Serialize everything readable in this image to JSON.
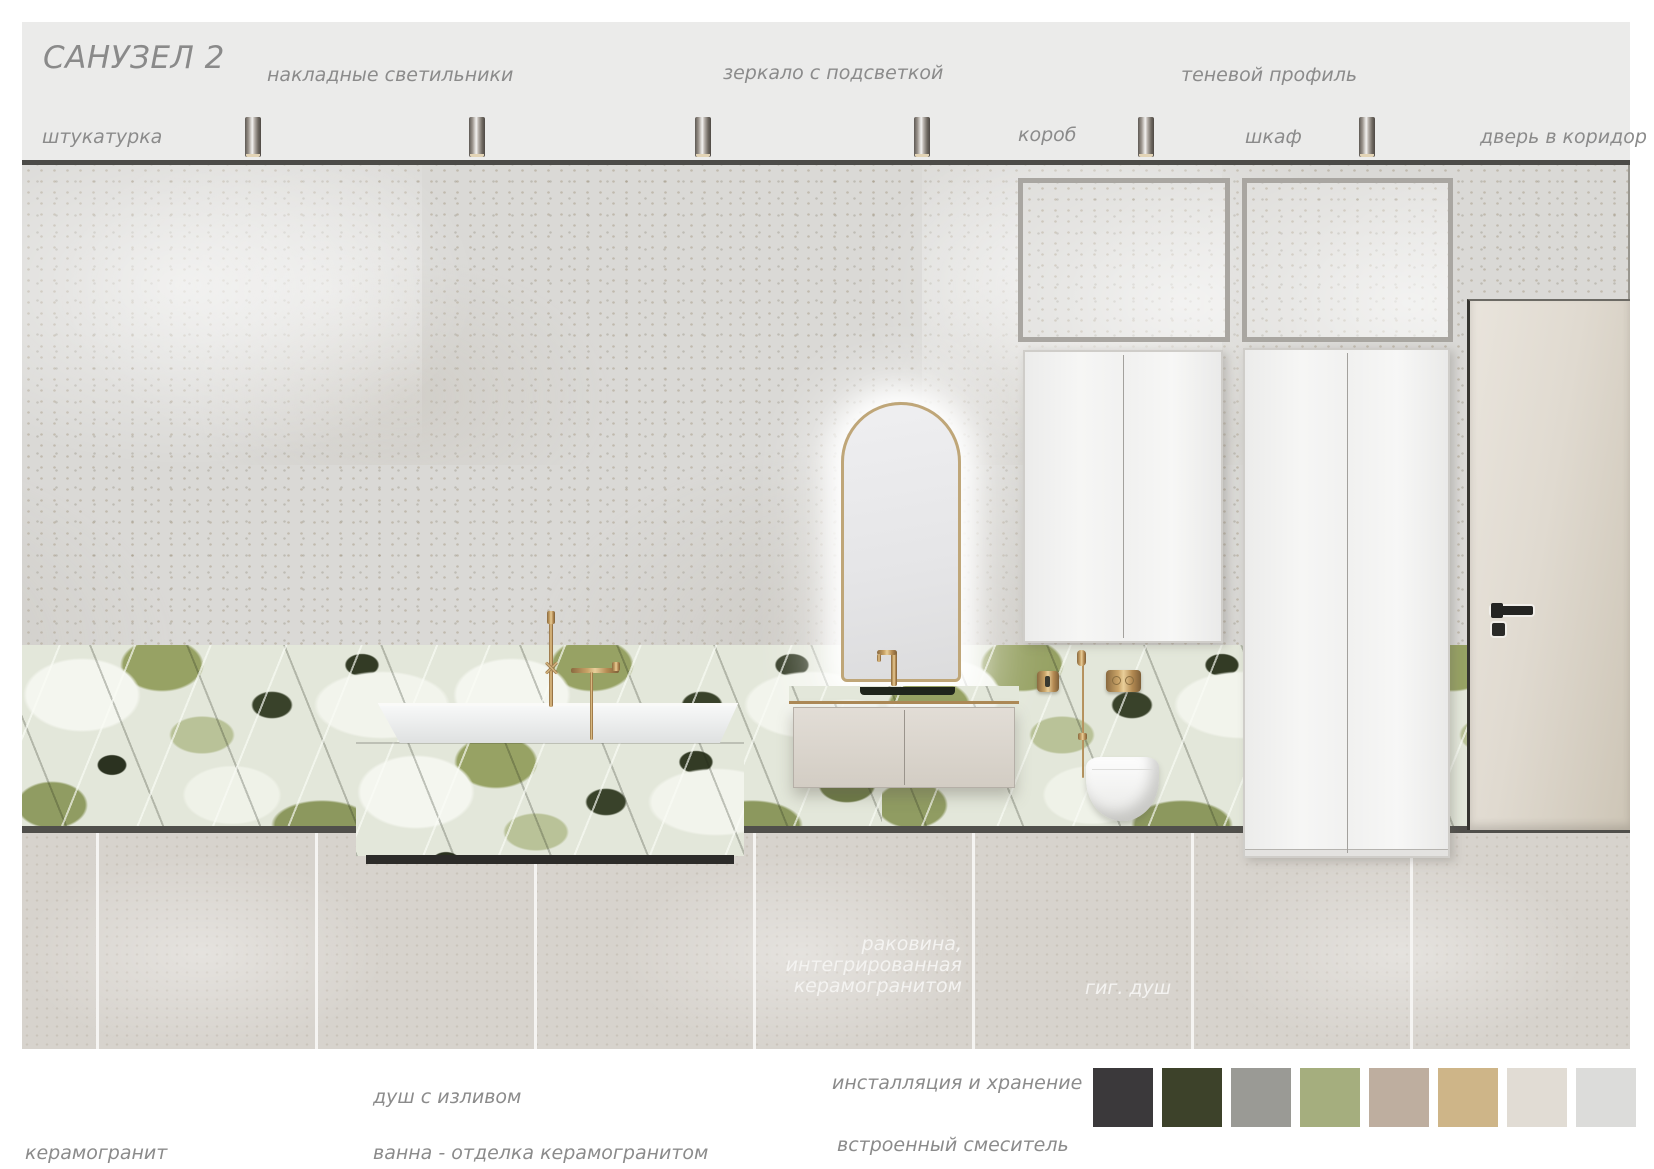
{
  "board": {
    "title": "САНУЗЕЛ 2",
    "callouts": {
      "lights": "накладные светильники",
      "mirror": "зеркало с подсветкой",
      "shadow_profile": "теневой профиль",
      "plaster": "штукатурка",
      "duct": "короб",
      "wardrobe": "шкаф",
      "door": "дверь в коридор"
    },
    "render_labels": {
      "sink_lines": [
        "раковина,",
        "интегрированная",
        "керамогранитом"
      ],
      "hyg_shower": "гиг. душ"
    },
    "legend": {
      "ceramic": "керамогранит",
      "shower_spout": "душ с изливом",
      "bath": "ванна - отделка керамогранитом",
      "installation": "инсталляция и хранение",
      "mixer": "встроенный смеситель"
    },
    "lights": {
      "count": 6
    },
    "palette": [
      "#3b393b",
      "#3d422a",
      "#9a9a95",
      "#a5ae7e",
      "#beae9f",
      "#ceb588",
      "#e1dcd4",
      "#dcdcda"
    ]
  }
}
